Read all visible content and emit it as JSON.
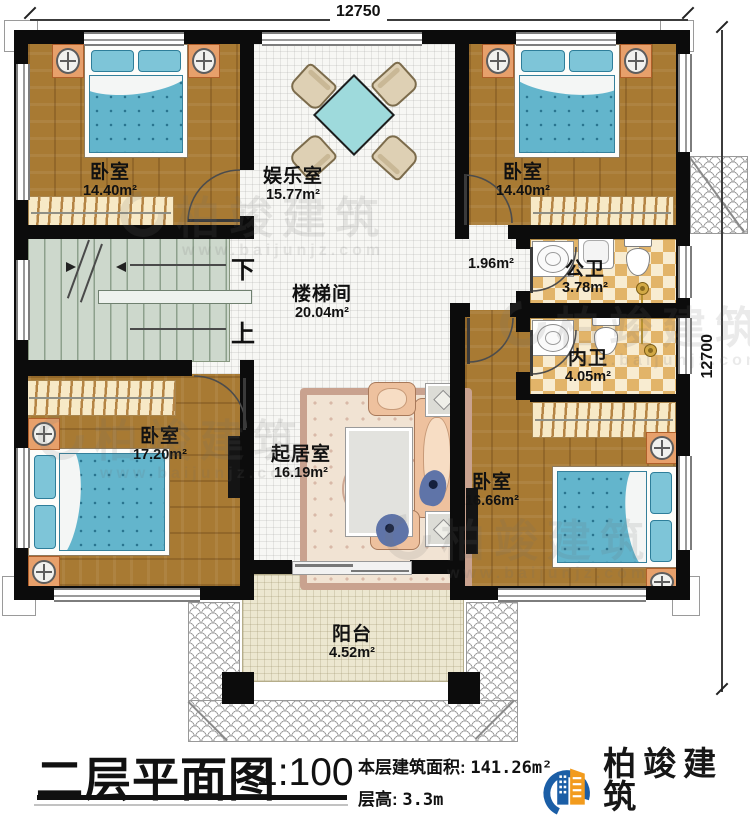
{
  "dimensions": {
    "top": "12750",
    "right": "12700"
  },
  "rooms": {
    "bedroom_tl": {
      "name": "卧室",
      "area": "14.40m²"
    },
    "entertainment": {
      "name": "娱乐室",
      "area": "15.77m²"
    },
    "bedroom_tr": {
      "name": "卧室",
      "area": "14.40m²"
    },
    "stairwell": {
      "name": "楼梯间",
      "area": "20.04m²"
    },
    "corridor": {
      "area": "1.96m²"
    },
    "public_bath": {
      "name": "公卫",
      "area": "3.78m²"
    },
    "inner_bath": {
      "name": "内卫",
      "area": "4.05m²"
    },
    "bedroom_bl": {
      "name": "卧室",
      "area": "17.20m²"
    },
    "living": {
      "name": "起居室",
      "area": "16.19m²"
    },
    "bedroom_br": {
      "name": "卧室",
      "area": "16.66m²"
    },
    "balcony": {
      "name": "阳台",
      "area": "4.52m²"
    }
  },
  "stairs": {
    "down": "下",
    "up": "上"
  },
  "footer": {
    "title": "二层平面图",
    "scale": "1:100",
    "area_label": "本层建筑面积:",
    "area_value": "141.26m²",
    "floor_height_label": "层高:",
    "floor_height_value": "3.3m"
  },
  "logo": {
    "name": "柏竣建筑",
    "url": "www.baijunjz.com"
  },
  "watermark": {
    "name": "柏竣建筑",
    "url": "www.baijunjz.com"
  },
  "colors": {
    "wall": "#0c0c0c",
    "wood_floor": "#a87a33",
    "bed_teal": "#63b5cc",
    "tile_checker": "#e2b469",
    "stairs_sage": "#cdd8cc",
    "logo_blue": "#1b5ea6",
    "logo_orange": "#f29b1d"
  }
}
